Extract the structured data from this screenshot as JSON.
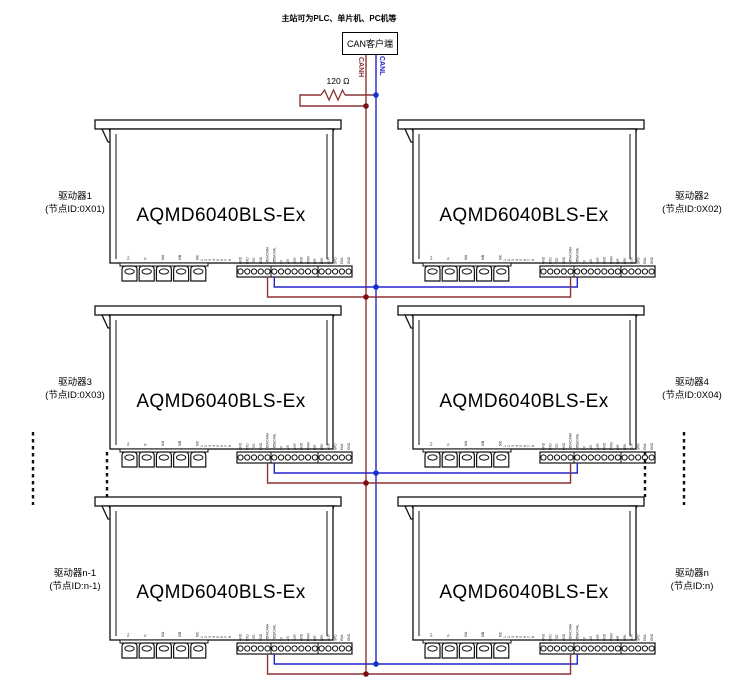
{
  "diagram": {
    "title_note": "主站可为PLC、单片机、PC机等",
    "master_box_label": "CAN客户端",
    "resistor_label": "120 Ω",
    "bus": {
      "canh_label": "CANH",
      "canl_label": "CANL",
      "canh_color": "#8b3434",
      "canl_color": "#2424cd",
      "canh_dot_color": "#7c1012",
      "canl_dot_color": "#1534cf"
    },
    "driver_model": "AQMD6040BLS-Ex",
    "drivers": [
      {
        "name": "驱动器1",
        "node_id": "(节点ID:0X01)",
        "side": "left",
        "row": 0
      },
      {
        "name": "驱动器2",
        "node_id": "(节点ID:0X02)",
        "side": "right",
        "row": 0
      },
      {
        "name": "驱动器3",
        "node_id": "(节点ID:0X03)",
        "side": "left",
        "row": 1
      },
      {
        "name": "驱动器4",
        "node_id": "(节点ID:0X04)",
        "side": "right",
        "row": 1
      },
      {
        "name": "驱动器n-1",
        "node_id": "(节点ID:n-1)",
        "side": "left",
        "row": 2
      },
      {
        "name": "驱动器n",
        "node_id": "(节点ID:n)",
        "side": "right",
        "row": 2
      }
    ],
    "power_pin_labels": [
      "V+",
      "V-",
      "MA",
      "MB",
      "MC"
    ],
    "aux_pin_labels": [
      "1",
      "2",
      "3",
      "4",
      "5",
      "6",
      "7",
      "8"
    ],
    "signal_pin_labels": [
      "GND",
      "RXD",
      "TXD",
      "GND",
      "485A/CANH",
      "485B/CANL",
      "5V",
      "AVI",
      "SVR",
      "GND",
      "PWM",
      "DIR",
      "BRK",
      "ALM",
      "SPD",
      "ENA",
      "GND"
    ],
    "canh_pin_index": 4,
    "canl_pin_index": 5
  }
}
